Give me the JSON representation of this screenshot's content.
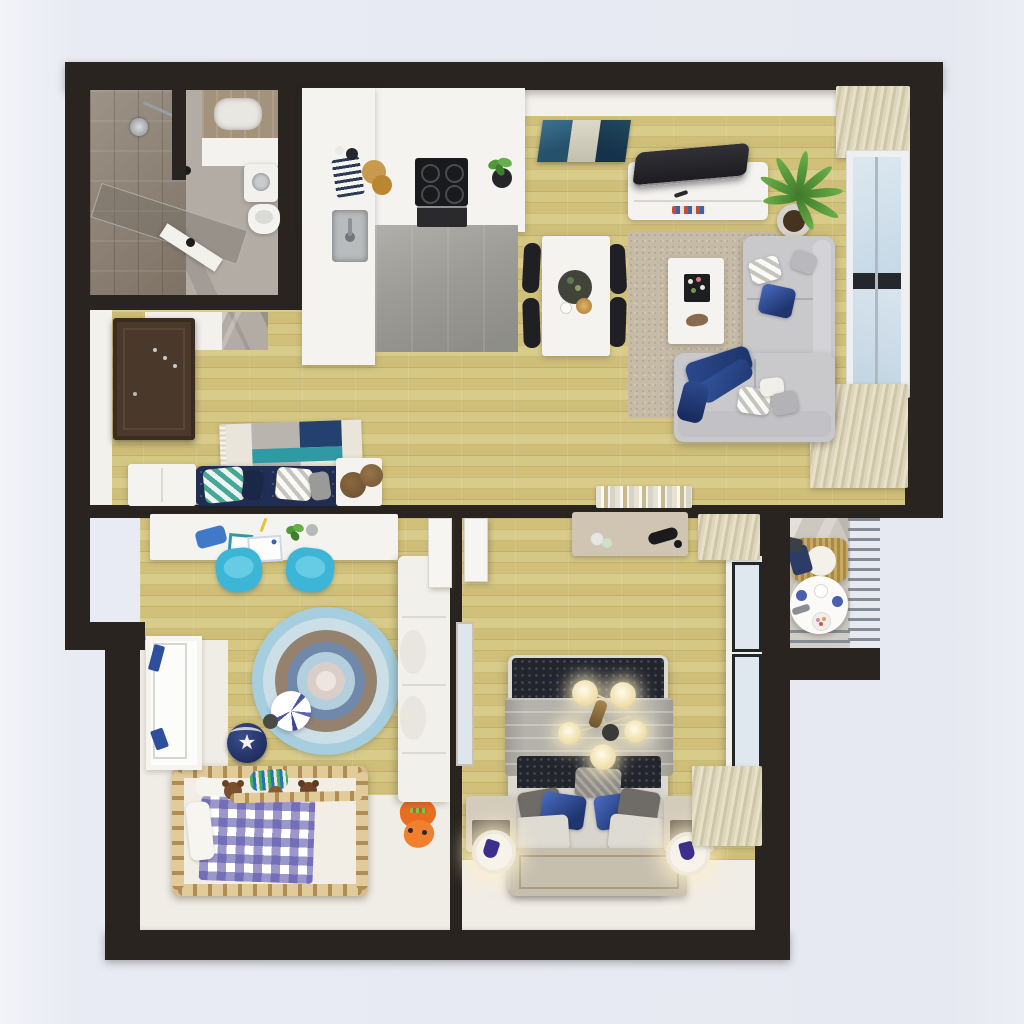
{
  "scene": {
    "label": "3D rendered top-down floor plan of a two-bedroom apartment",
    "style": "photorealistic architectural render, top view, no visible text",
    "background_color": "#e8eaf3",
    "wall_color": "#29241f"
  },
  "palette": {
    "wood_floor": "#d5c785",
    "concrete_floor": "#9c9b96",
    "bathroom_marble": "#b2aca5",
    "white_surface": "#f5f3ef",
    "sofa_gray": "#c9c9cc",
    "living_rug": "#c6bba7",
    "curtain_beige": "#d9d1b6",
    "accent_navy": "#2e4a94",
    "accent_teal": "#36a0ac",
    "kids_chair_blue": "#3cb5d6",
    "crib_wood": "#d9bd8c",
    "gingham_blue": "#5f58a8",
    "toy_orange": "#ea6d1f",
    "plant_green": "#55933c",
    "lamp_glow": "#fdf3d0"
  },
  "rooms": {
    "bathroom": {
      "label": "Bathroom",
      "items": {
        "shower": "Walk-in shower with glass panel and chrome head",
        "vanity": "Wood vanity counter with white basin",
        "washer": "Washing machine",
        "toilet": "Toilet",
        "door": "Open white door"
      }
    },
    "kitchen": {
      "label": "Kitchen",
      "items": {
        "counter": "White L-shaped counter",
        "cooktop": "Black four-burner cooktop",
        "oven": "Built-in oven",
        "sink": "Stainless sink with faucet",
        "boards": "Round wooden cutting boards",
        "towel": "Navy striped kitchen towel",
        "plant": "Potted herb",
        "floor": "Gray concrete floor zone"
      }
    },
    "dining": {
      "label": "Dining area",
      "items": {
        "table": "White rectangular dining table",
        "chairs": "Four black dining chairs",
        "tray": "Dark round serving tray with greenery",
        "bowl": "Gold bowl"
      }
    },
    "living": {
      "label": "Living room",
      "items": {
        "art": "Blue abstract wall art",
        "tv": "Curved dark flat-screen TV",
        "tv_stand": "White media stand with magazines",
        "plant": "Tall green potted plant",
        "window": "Large window with beige pleated curtains",
        "rug": "Beige speckled area rug",
        "sofa": "Light-gray corner sofa with cushions",
        "throw": "Navy throw blanket",
        "coffee_table": "White coffee table with flower tray",
        "books": "Row of books along the wall"
      }
    },
    "hallway": {
      "label": "Entry hallway",
      "items": {
        "door": "Dark brown entry door with coat hooks",
        "rug": "Patchwork runner rug in cream, gray, navy and teal",
        "bench": "Navy tufted bench with chevron pillows",
        "poufs": "Two brown wicker poufs",
        "cabinet": "White storage cabinets"
      }
    },
    "kids": {
      "label": "Kids room",
      "items": {
        "desk": "White study desk with art supplies and plant",
        "chairs": "Two blue desk chairs",
        "rug": "Round crochet rug in blue and taupe rings",
        "crib": "Wooden crib with blue gingham blanket and teddy bears",
        "ball": "Navy ball with white star",
        "pom": "Blue-and-white pom decor",
        "toy": "Orange plush toy",
        "wardrobe": "White wardrobe unit",
        "window": "Window with navy curtain accents"
      }
    },
    "bedroom": {
      "label": "Bedroom",
      "items": {
        "bed": "Upholstered bed with navy quilted bands and gray wrap",
        "pillows": "Gray and royal-blue satin pillows",
        "mat": "Beige quilted foot mat",
        "nightstands": "Two taupe nightstands",
        "lamps": "Two glowing white ring bedside lamps",
        "chandelier": "Five-globe glowing chandelier",
        "desk": "Wall desk with black lamp and cups",
        "window": "Right-wall windows with pleated curtains",
        "frame": "Leaning picture frame",
        "doors": "Open white interior doors"
      }
    },
    "balcony": {
      "label": "Balcony",
      "items": {
        "railing": "Gray horizontal-bar metal railing",
        "table": "Round white bistro table with cups and sweets",
        "chair": "Wicker chair with navy blanket",
        "floor": "Stone balcony floor"
      }
    }
  }
}
